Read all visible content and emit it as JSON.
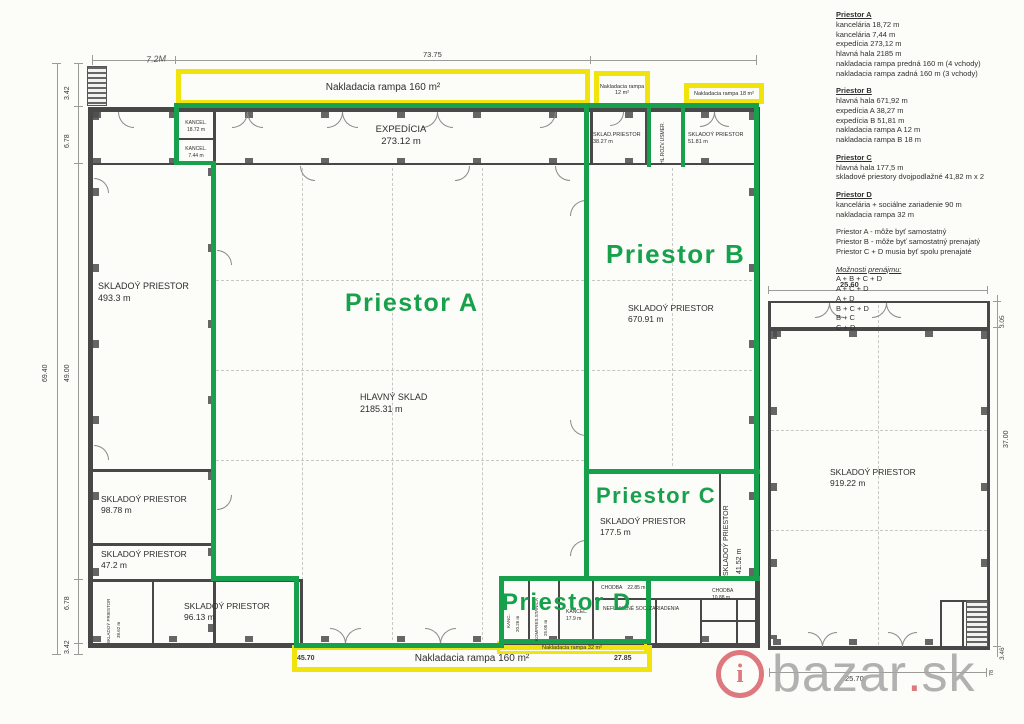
{
  "colors": {
    "green": "#18a14c",
    "yellow": "#f0e40c",
    "wall": "#484848",
    "watermark_gray": "#a7a7a7",
    "watermark_red": "#d9666e"
  },
  "spaces": {
    "a": "Priestor A",
    "b": "Priestor B",
    "c": "Priestor C",
    "d": "Priestor D"
  },
  "rooms": {
    "kancel1": {
      "n": "KANCEL.",
      "a": "18.72 m"
    },
    "kancel2": {
      "n": "KANCEL.",
      "a": "7.44 m"
    },
    "expedicia": {
      "n": "EXPEDÍCIA",
      "a": "273.12 m"
    },
    "sklad3827": {
      "n": "SKLAD.PRIESTOR",
      "a": "38.27 m"
    },
    "hlrozv": {
      "n": "HL.ROZV.USMER."
    },
    "sklad5181": {
      "n": "SKLADOÝ PRIESTOR",
      "a": "51.81 m"
    },
    "sklad4933": {
      "n": "SKLADOÝ PRIESTOR",
      "a": "493.3 m"
    },
    "hlavnysklad": {
      "n": "HLAVNÝ SKLAD",
      "a": "2185.31 m"
    },
    "sklad67091": {
      "n": "SKLADOÝ PRIESTOR",
      "a": "670.91 m"
    },
    "sklad9878": {
      "n": "SKLADOÝ PRIESTOR",
      "a": "98.78 m"
    },
    "sklad472": {
      "n": "SKLADOÝ PRIESTOR",
      "a": "47.2 m"
    },
    "sklad3862": {
      "n": "SKLADOÝ PRIESTOR",
      "a": "38.62 m"
    },
    "sklad9613": {
      "n": "SKLADOÝ PRIESTOR",
      "a": "96.13 m"
    },
    "sklad1775": {
      "n": "SKLADOÝ PRIESTOR",
      "a": "177.5 m"
    },
    "sklad4152": {
      "n": "SKLADOÝ PRIESTOR",
      "a": "41.52 m"
    },
    "sklad91922": {
      "n": "SKLADOÝ PRIESTOR",
      "a": "919.22 m"
    },
    "kanc2026": {
      "n": "KANC.",
      "a": "20.26 m"
    },
    "kompres": {
      "n": "KOMPRES.STANICA",
      "a": "25.05 m"
    },
    "kancel179": {
      "n": "KANCEL.",
      "a": "17.9 m"
    },
    "chodba1": {
      "n": "CHODBA",
      "a": "22.85 m"
    },
    "soc": {
      "n": "NEFUNKČNÉ SOC. ZARIADENIA"
    },
    "chodba2": {
      "n": "CHODBA",
      "a": "10.88 m"
    }
  },
  "ramps": {
    "top160": "Nakladacia rampa 160 m²",
    "r12": "Nakladacia rampa 12 m²",
    "r18": "Nakladacia rampa 18 m²",
    "bottom160": "Nakladacia rampa 160 m²",
    "r32": "Nakladacia rampa 32 m²"
  },
  "dims": {
    "top": "73.75",
    "hand": "7.2M",
    "l1": "3.42",
    "l2": "6.78",
    "l3": "69.40",
    "l4": "49.00",
    "l5": "6.78",
    "l6": "3.42",
    "b1": "45.70",
    "b2": "27.85",
    "b3": "25.70",
    "r1": "25.60",
    "r2": "3.05",
    "r3": "37.00",
    "r4": "3.46",
    "r5": "78"
  },
  "legend": {
    "sections": [
      {
        "title": "Priestor A",
        "lines": [
          "kancelária 18,72 m",
          "kancelária 7,44 m",
          "expedícia 273,12 m",
          "hlavná hala 2185 m",
          "nakladacia rampa predná 160 m (4 vchody)",
          "nakladacia rampa zadná 160 m (3 vchody)"
        ]
      },
      {
        "title": "Priestor B",
        "lines": [
          "hlavná hala 671,92 m",
          "expedícia A 38,27 m",
          "expedícia B 51,81 m",
          "nakladacia rampa A 12 m",
          "nakladacia rampa B 18 m"
        ]
      },
      {
        "title": "Priestor C",
        "lines": [
          "hlavná hala 177,5 m",
          "skladové priestory dvojpodlažné 41,82 m x 2"
        ]
      },
      {
        "title": "Priestor D",
        "lines": [
          "kancelária + sociálne zariadenie 90 m",
          "nakladacia rampa 32 m"
        ]
      }
    ],
    "notes": [
      "Priestor A - môže byť samostatný",
      "Priestor B - môže byť samostatný prenajatý",
      "Priestor C + D musia byť spolu prenajaté"
    ],
    "options_title": "Možnosti prenájmu:",
    "options": [
      "A + B + C + D",
      "A + C + D",
      "A + D",
      "B + C + D",
      "B + C",
      "C + D"
    ]
  },
  "watermark": {
    "i": "i",
    "name": "bazar",
    "dot": ".",
    "tld": "sk"
  }
}
